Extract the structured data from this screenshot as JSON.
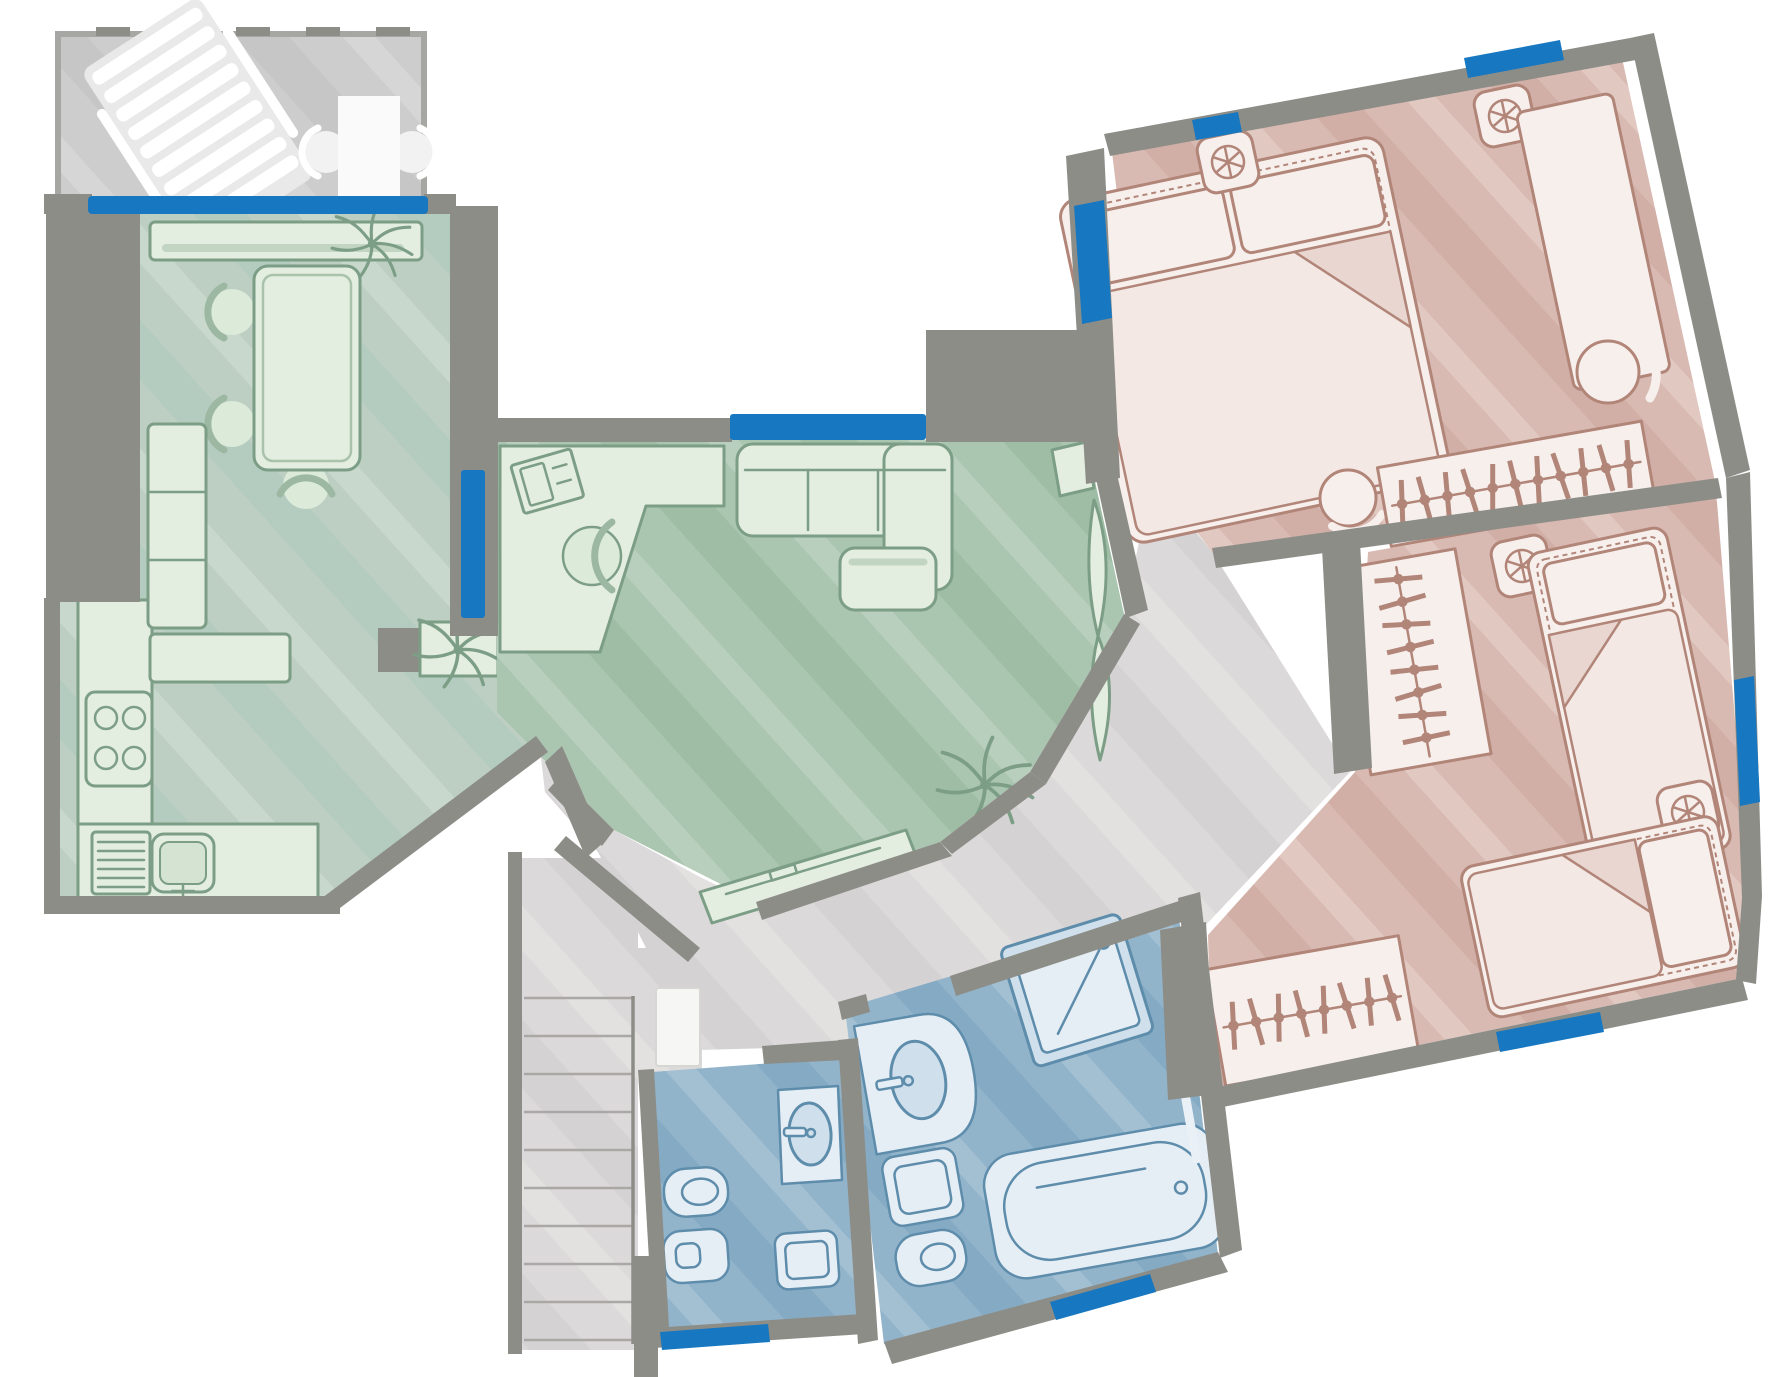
{
  "plan": {
    "label": "Apartment floor plan (top view, hand-drawn style)",
    "walls_color": "#8d8d88",
    "window_color": "#1777c0",
    "background": "#ffffff",
    "windows_count": 10,
    "rooms": [
      {
        "id": "balcony",
        "label": "Balcony",
        "floor_color": "#cdcdcd",
        "furniture": [
          "sun-lounger",
          "bistro-table",
          "chair",
          "chair"
        ]
      },
      {
        "id": "dining-room",
        "label": "Dining room",
        "floor_color": "#bdcfc2",
        "furniture": [
          "sideboard",
          "dining-table",
          "chair",
          "chair",
          "chair",
          "tall-cabinet",
          "counter",
          "plant",
          "pillar",
          "console-shelf",
          "plant"
        ]
      },
      {
        "id": "kitchen",
        "label": "Kitchen",
        "floor_color": "#bdcfc2",
        "furniture": [
          "counter-l-shape",
          "stove-4-burners",
          "sink-with-drainboard"
        ]
      },
      {
        "id": "living-room",
        "label": "Living room",
        "floor_color": "#aac5b0",
        "furniture": [
          "corner-desk",
          "office-chair",
          "laptop",
          "sofa-with-chaise",
          "wall-shelf",
          "coffee-table",
          "tv-console",
          "plant",
          "curtain-decor"
        ]
      },
      {
        "id": "hallway",
        "label": "Hallway",
        "floor_color": "#dcd9da",
        "furniture": [
          "staircase",
          "doormat"
        ],
        "stair_treads": 11
      },
      {
        "id": "wc",
        "label": "Guest WC",
        "floor_color": "#92b4cb",
        "furniture": [
          "washbasin",
          "bidet",
          "toilet",
          "washing-machine"
        ]
      },
      {
        "id": "bathroom",
        "label": "Bathroom",
        "floor_color": "#92b4cb",
        "furniture": [
          "shower",
          "washbasin-vanity",
          "washing-machine",
          "toilet",
          "bathtub",
          "towel-rail"
        ]
      },
      {
        "id": "master-bedroom",
        "label": "Master bedroom",
        "floor_color": "#d8bab2",
        "rotation_deg": -12,
        "furniture": [
          "double-bed",
          "ceiling-fan",
          "ceiling-fan",
          "tall-wardrobe",
          "pouf",
          "floor-globe-lamp",
          "open-wardrobe-hangers"
        ],
        "hangers": 11
      },
      {
        "id": "kids-bedroom",
        "label": "Second bedroom",
        "floor_color": "#d8bab2",
        "rotation_deg": -12,
        "furniture": [
          "single-bed",
          "single-bed",
          "ceiling-fan",
          "ceiling-fan",
          "open-wardrobe-hangers",
          "open-wardrobe-hangers"
        ],
        "hangers": 16
      }
    ]
  }
}
